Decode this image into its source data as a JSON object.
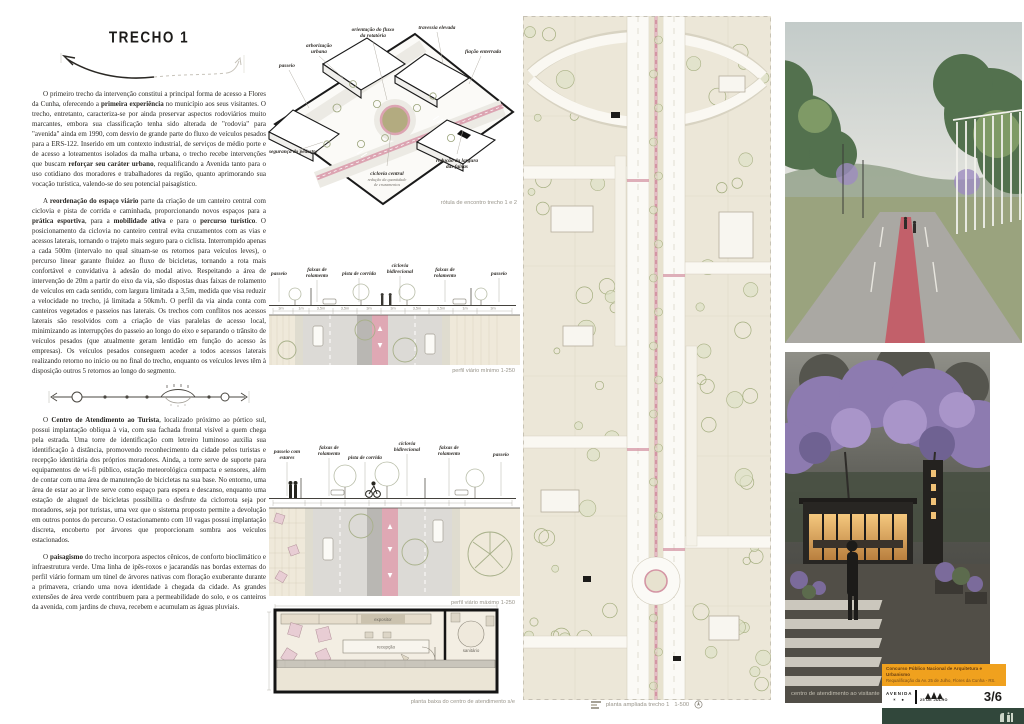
{
  "board": {
    "section_title": "TRECHO 1",
    "paragraphs_top": [
      {
        "segments": [
          {
            "t": "O primeiro trecho da intervenção constitui a principal forma de acesso a Flores da Cunha, oferecendo a "
          },
          {
            "t": "primeira experiência",
            "b": true
          },
          {
            "t": " no município aos seus visitantes. O trecho, entretanto, caracteriza-se por ainda preservar aspectos rodoviários muito marcantes, embora sua classificação tenha sido alterada de \"rodovia\" para \"avenida\" ainda em 1990, com desvio de grande parte do fluxo de veículos pesados para a ERS-122. Inserido em um contexto industrial, de serviços de médio porte e de acesso a loteamentos isolados da malha urbana, o trecho recebe intervenções que buscam "
          },
          {
            "t": "reforçar seu caráter urbano",
            "b": true
          },
          {
            "t": ", requalificando a Avenida tanto para o uso cotidiano dos moradores e trabalhadores da região, quanto aprimorando sua vocação turística, valendo-se do seu potencial paisagístico."
          }
        ]
      },
      {
        "segments": [
          {
            "t": "A "
          },
          {
            "t": "reordenação do espaço viário",
            "b": true
          },
          {
            "t": " parte da criação de um canteiro central com ciclovia e pista de corrida e caminhada, proporcionando novos espaços para a "
          },
          {
            "t": "prática esportiva",
            "b": true
          },
          {
            "t": ", para a "
          },
          {
            "t": "mobilidade ativa",
            "b": true
          },
          {
            "t": " e para o "
          },
          {
            "t": "percurso turístico",
            "b": true
          },
          {
            "t": ". O posicionamento da ciclovia no canteiro central evita cruzamentos com as vias e acessos laterais, tornando o trajeto mais seguro para o ciclista. Interrompido apenas a cada 500m (intervalo no qual situam-se os retornos para veículos leves), o percurso linear garante fluidez ao fluxo de bicicletas, tornando a rota mais confortável e convidativa à adesão do modal ativo. Respeitando a área de intervenção de 20m a partir do eixo da via, são dispostas duas faixas de rolamento de veículos em cada sentido, com largura limitada a 3,5m, medida que visa reduzir a velocidade no trecho, já limitada a 50km/h. O perfil da via ainda conta com canteiros vegetados e passeios nas laterais. Os trechos com conflitos nos acessos laterais são resolvidos com a criação de vias paralelas de acesso local, minimizando as interrupções do passeio ao longo do eixo e separando o trânsito de veículos pesados (que atualmente geram lentidão em função do acesso às empresas). Os veículos pesados conseguem aceder a todos acessos laterais realizando retorno no início ou no final do trecho, enquanto os veículos leves têm à disposição outros 5 retornos ao longo do segmento."
          }
        ]
      }
    ],
    "paragraphs_bottom": [
      {
        "segments": [
          {
            "t": "O "
          },
          {
            "t": "Centro de Atendimento ao Turista",
            "b": true
          },
          {
            "t": ", localizado próximo ao pórtico sul, possui implantação oblíqua à via, com sua fachada frontal visível a quem chega pela estrada. Uma torre de identificação com letreiro luminoso auxilia sua identificação à distância, promovendo reconhecimento da cidade pelos turistas e recepção identitária dos próprios moradores. Ainda, a torre serve de suporte para equipamentos de wi-fi público, estação meteorológica compacta e sensores, além de contar com uma área de manutenção de bicicletas na sua base. No entorno, uma área de estar ao ar livre serve como espaço para espera e descanso, enquanto uma estação de aluguel de bicicletas possibilita o desfrute da ciclorrota seja por moradores, seja por turistas, uma vez que o sistema proposto permite a devolução em outros pontos do percurso. O estacionamento com 10 vagas possui implantação discreta, encoberto por árvores que proporcionam sombra aos veículos estacionados."
          }
        ]
      },
      {
        "segments": [
          {
            "t": "O "
          },
          {
            "t": "paisagismo",
            "b": true
          },
          {
            "t": " do trecho incorpora aspectos cênicos, de conforto bioclimático e infraestrutura verde. Uma linha de ipês-roxos e jacarandás nas bordas externas do perfil viário formam um túnel de árvores nativas com floração exuberante durante a primavera, criando uma nova identidade à chegada da cidade. As grandes extensões de área verde contribuem para a permeabilidade do solo, e os canteiros da avenida, com jardins de chuva, recebem e acumulam as águas pluviais."
          }
        ]
      }
    ]
  },
  "axon": {
    "labels": {
      "passeio": "passeio",
      "arborizacao_1": "arborização",
      "arborizacao_2": "urbana",
      "fluxo_1": "orientação do fluxo",
      "fluxo_2": "da rotatória",
      "travessia": "travessia elevada",
      "fiacao": "fiação enterrada",
      "seguranca": "segurança do pedestre",
      "ciclovia": "ciclovia central",
      "ciclovia_sub1": "redução da quantidade",
      "ciclovia_sub2": "de cruzamentos",
      "reducao_1": "redução da largura",
      "reducao_2": "das faixas"
    },
    "caption": "rótula de encontro trecho 1  e 2"
  },
  "profiles": {
    "labels": {
      "passeio": "passeio",
      "estares_1": "passeio com",
      "estares_2": "estares",
      "faixas_1": "faixas de",
      "faixas_2": "rolamento",
      "pista": "pista de corrida",
      "ciclovia_1": "ciclovia",
      "ciclovia_2": "bidirecional"
    },
    "lane_dims": [
      "3m",
      "1m",
      "3,5m",
      "3,5m",
      "3m",
      "3m",
      "3,5m",
      "3,5m",
      "1m",
      "3m"
    ],
    "min_caption": "perfil viário mínimo 1-250",
    "max_caption": "perfil viário máximo 1-250"
  },
  "floorplan": {
    "rooms": {
      "expositor": "expositor",
      "recepcao": "recepção",
      "sanitario": "sanitário"
    },
    "caption": "planta baixa do centro de atendimento  s/e"
  },
  "siteplan": {
    "caption": "planta ampliada trecho 1",
    "scale": "1-500"
  },
  "photos": {
    "bottom_caption": "centro de atendimento ao visitante"
  },
  "badge": {
    "line1": "Concurso Público Nacional de Arquitetura e Urbanismo",
    "line2": "Requalificação da Av. 25 de Julho, Flores da Cunha - RS.",
    "logo_top": "AVENIDA",
    "logo_icons": "☀ ●",
    "logo_bottom": "25 DE JULHO",
    "page": "3/6"
  }
}
